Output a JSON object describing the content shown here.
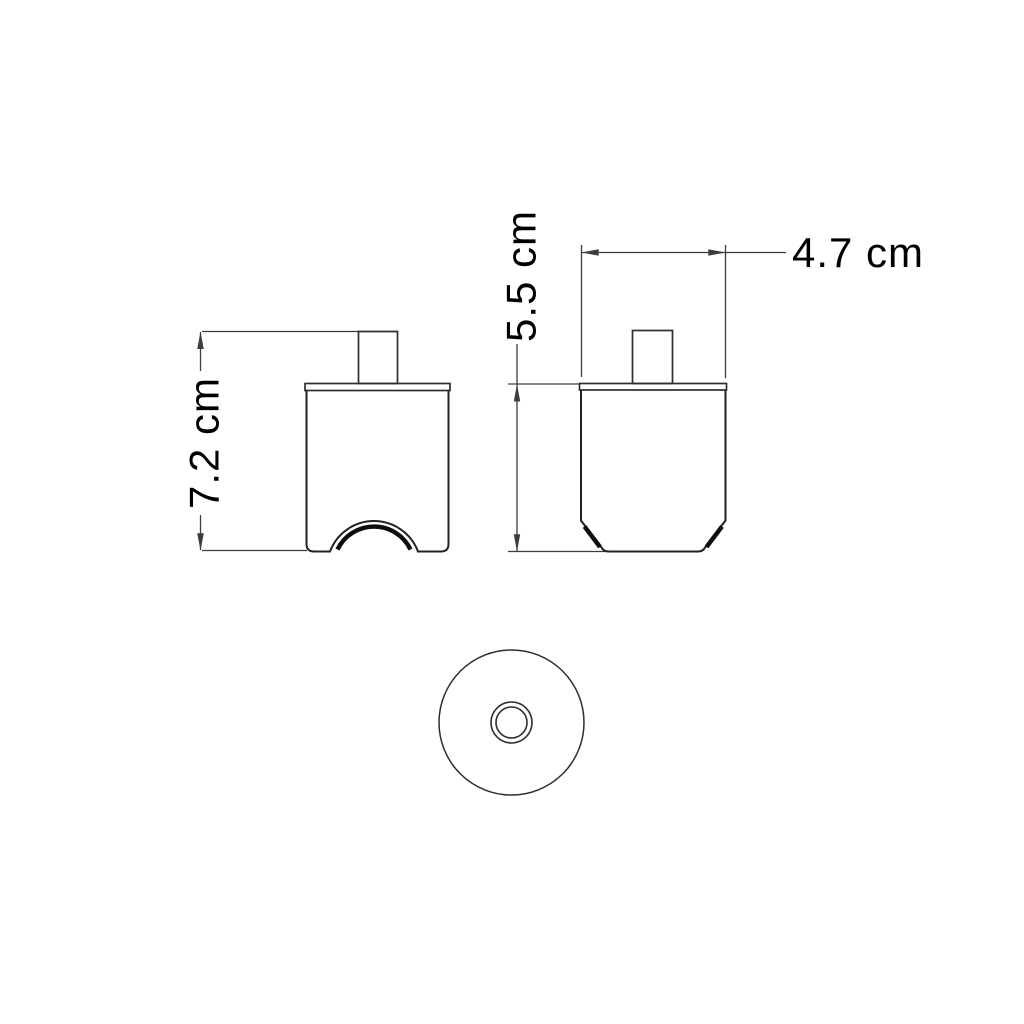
{
  "page": {
    "background": "#ffffff",
    "line_color": "#2b2b2b",
    "text_color": "#000000"
  },
  "drawing": {
    "kind": "technical-dimension-drawing",
    "views": {
      "front": {
        "name": "front view"
      },
      "side": {
        "name": "side view"
      },
      "bottom": {
        "name": "bottom view"
      }
    },
    "dimensions": {
      "front_overall_height": "7.2 cm",
      "side_body_height": "5.5 cm",
      "side_top_width": "4.7 cm"
    }
  }
}
